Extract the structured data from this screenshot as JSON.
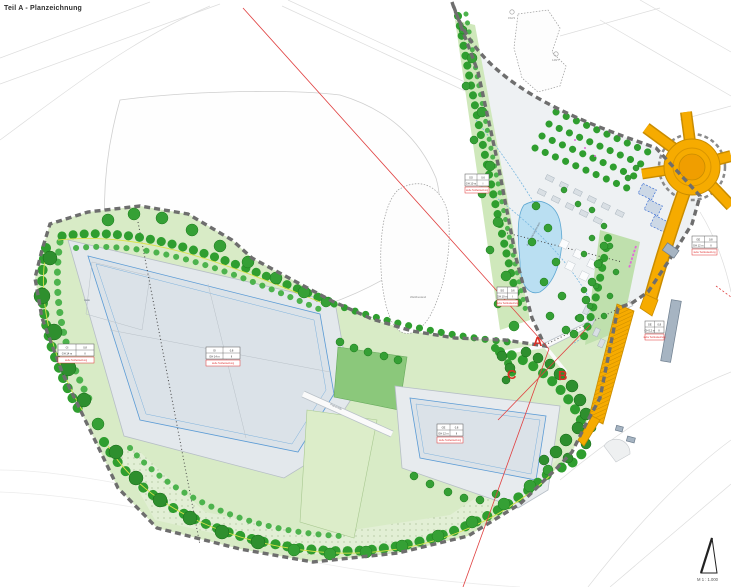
{
  "title": "Teil A - Planzeichnung",
  "scale_label": "M 1 : 1.000",
  "markers": {
    "a": "A",
    "b": "B",
    "c": "C"
  },
  "map_labels": {
    "forest": "Waldbestand",
    "pond": "Regenrückhaltebecken",
    "road": "Planstraße",
    "building_left": "Halle",
    "ref1": "152/3",
    "ref2": "148/7"
  },
  "legend_colors": {
    "tree_green": "#2f9e2f",
    "pad_gray": "#dde3e9",
    "road_orange": "#f6ab00",
    "water_blue": "#badff2",
    "boundary_gray": "#6e6e6e",
    "marker_red": "#d93025"
  },
  "schablonen": [
    {
      "x": 58,
      "y": 344,
      "w": 36,
      "cells": [
        [
          "GI",
          "0,8"
        ],
        [
          "GH 14 m",
          "II"
        ]
      ],
      "red": "siehe Textfestsetzung"
    },
    {
      "x": 206,
      "y": 347,
      "w": 34,
      "cells": [
        [
          "GI",
          "0,8"
        ],
        [
          "GH 14 m",
          "II"
        ]
      ],
      "red": "siehe Textfestsetzung"
    },
    {
      "x": 437,
      "y": 424,
      "w": 26,
      "cells": [
        [
          "GE",
          "0,8"
        ],
        [
          "GH 12 m",
          "II"
        ]
      ],
      "red": "siehe Textfestsetzung"
    },
    {
      "x": 465,
      "y": 174,
      "w": 24,
      "cells": [
        [
          "SO",
          "0,6"
        ],
        [
          "GH 10 m",
          "I"
        ]
      ],
      "red": "siehe Textfestsetzung"
    },
    {
      "x": 497,
      "y": 287,
      "w": 21,
      "cells": [
        [
          "SO",
          "0,6"
        ],
        [
          "GH 10 m",
          "I"
        ]
      ],
      "red": "siehe Textfestsetzung"
    },
    {
      "x": 692,
      "y": 236,
      "w": 25,
      "cells": [
        [
          "GE",
          "0,8"
        ],
        [
          "GH 12 m",
          "II"
        ]
      ],
      "red": "siehe Textfestsetzung"
    },
    {
      "x": 645,
      "y": 321,
      "w": 19,
      "cells": [
        [
          "GE",
          "0,8"
        ],
        [
          "GH 12 m",
          "II"
        ]
      ],
      "red": "siehe Textfestsetzung"
    }
  ]
}
